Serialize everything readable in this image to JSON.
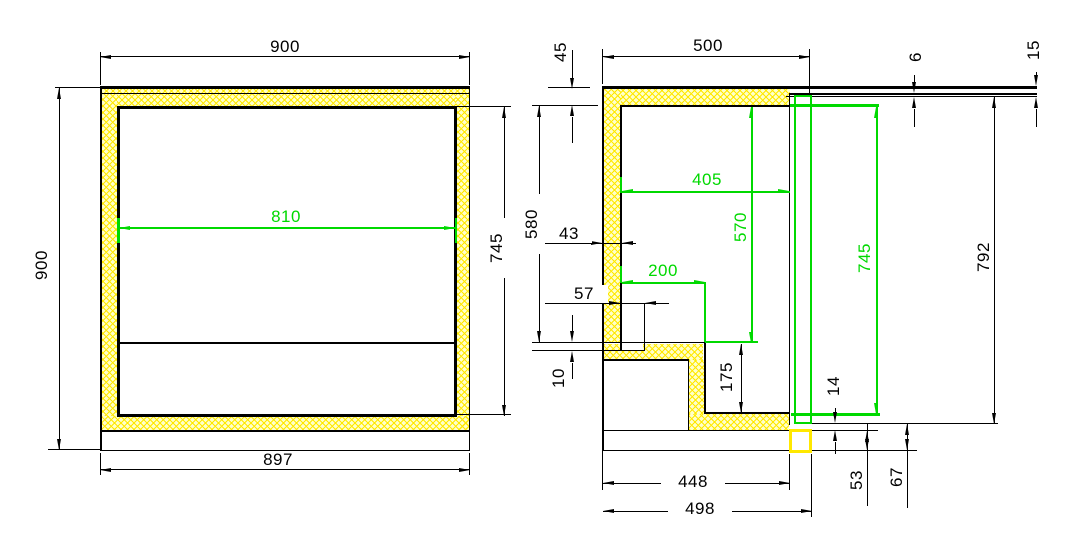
{
  "front_view": {
    "label_overall_width": "900",
    "label_overall_height": "900",
    "label_inner_width": "810",
    "label_inner_height": "745",
    "label_base_width": "897"
  },
  "side_view": {
    "label_top_insulation": "45",
    "label_overall_depth": "500",
    "label_worktop_gap": "6",
    "label_worktop_edge": "15",
    "label_inner_height_rear": "580",
    "label_wall_thickness": "43",
    "label_inner_depth": "405",
    "label_inner_height_front": "570",
    "label_floor_depth": "200",
    "label_channel_width": "57",
    "label_channel_depth": "10",
    "label_step_height": "175",
    "label_door_inner_height": "745",
    "label_door_height": "792",
    "label_door_bottom_gap": "14",
    "label_plinth_height": "53",
    "label_base_gap": "67",
    "label_base_depth": "448",
    "label_total_depth": "498"
  },
  "colors": {
    "line": "#000000",
    "highlight_green": "#00d900",
    "insulation_fill": "#ffffc9",
    "insulation_hatch": "#ffe800"
  }
}
